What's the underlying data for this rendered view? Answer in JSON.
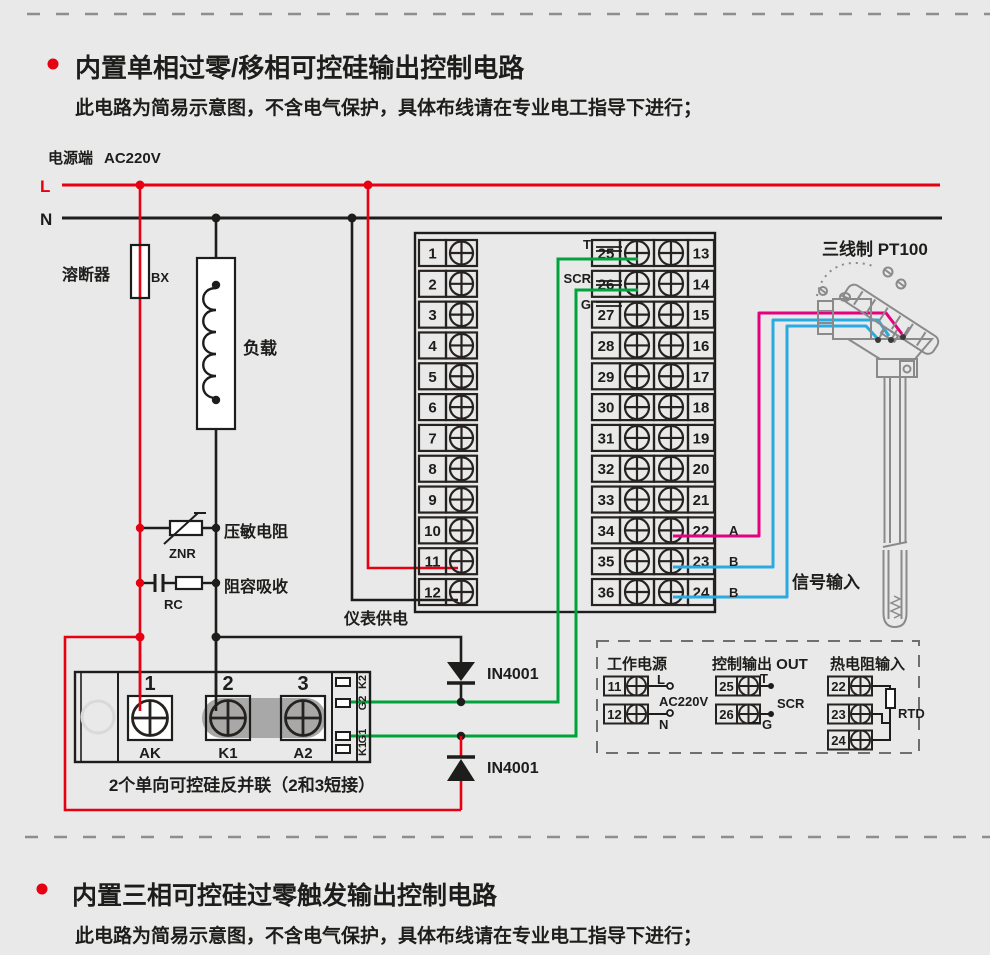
{
  "colors": {
    "bg": "#e9e9e9",
    "red": "#e60012",
    "green": "#00a23c",
    "magenta": "#e5007f",
    "blue": "#29abe2",
    "ink": "#1d1d1b",
    "sensor_gray": "#8a8a8a"
  },
  "sections": [
    {
      "title": "内置单相过零/移相可控硅输出控制电路",
      "subtitle": "此电路为简易示意图，不含电气保护，具体布线请在专业电工指导下进行；"
    },
    {
      "title": "内置三相可控硅过零触发输出控制电路",
      "subtitle": "此电路为简易示意图，不含电气保护，具体布线请在专业电工指导下进行；"
    }
  ],
  "power": {
    "terminal_label": "电源端",
    "voltage": "AC220V",
    "live": "L",
    "neutral": "N"
  },
  "components": {
    "fuse_label": "溶断器",
    "fuse_code": "BX",
    "load_label": "负载",
    "varistor_label": "压敏电阻",
    "varistor_code": "ZNR",
    "rc_label": "阻容吸收",
    "rc_code": "RC",
    "meter_supply_label": "仪表供电",
    "diode_top": "IN4001",
    "diode_bottom": "IN4001"
  },
  "scr_module": {
    "numbers": [
      "1",
      "2",
      "3"
    ],
    "labels": [
      "AK",
      "K1",
      "A2"
    ],
    "pins": [
      "K2",
      "G2",
      "G1",
      "K1"
    ],
    "caption": "2个单向可控硅反并联（2和3短接）"
  },
  "terminal_block": {
    "left": [
      "1",
      "2",
      "3",
      "4",
      "5",
      "6",
      "7",
      "8",
      "9",
      "10",
      "11",
      "12"
    ],
    "mid": [
      "25",
      "26",
      "27",
      "28",
      "29",
      "30",
      "31",
      "32",
      "33",
      "34",
      "35",
      "36"
    ],
    "right": [
      "13",
      "14",
      "15",
      "16",
      "17",
      "18",
      "19",
      "20",
      "21",
      "22",
      "23",
      "24"
    ],
    "t": "T",
    "scr": "SCR",
    "g": "G",
    "wire_a": "A",
    "wire_b1": "B",
    "wire_b2": "B"
  },
  "sensor": {
    "title": "三线制 PT100",
    "signal": "信号输入"
  },
  "legend": {
    "power_title": "工作电源",
    "power_terms": [
      "11",
      "12"
    ],
    "power_l": "L",
    "power_v": "AC220V",
    "power_n": "N",
    "out_title": "控制输出 OUT",
    "out_terms": [
      "25",
      "26"
    ],
    "out_t": "T",
    "out_scr": "SCR",
    "out_g": "G",
    "rtd_title": "热电阻输入",
    "rtd_terms": [
      "22",
      "23",
      "24"
    ],
    "rtd_label": "RTD"
  }
}
